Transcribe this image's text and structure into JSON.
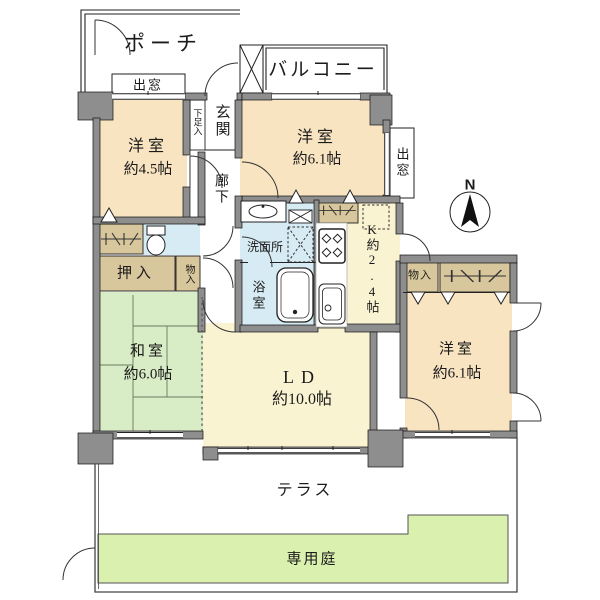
{
  "compass": {
    "north": "N"
  },
  "outdoor": {
    "porch": "ポーチ",
    "balcony": "バルコニー",
    "terrace": "テラス",
    "garden": "専用庭",
    "bay_window_top": "出窓",
    "bay_window_right": "出窓"
  },
  "entrance": {
    "genkan": "玄関",
    "shoe_cabinet": "下足入",
    "hallway": "廊下"
  },
  "rooms": {
    "western1": {
      "name": "洋室",
      "size": "約4.5帖"
    },
    "western2": {
      "name": "洋室",
      "size": "約6.1帖"
    },
    "western3": {
      "name": "洋室",
      "size": "約6.1帖"
    },
    "japanese": {
      "name": "和室",
      "size": "約6.0帖"
    },
    "living_dining": {
      "name": "LD",
      "size": "約10.0帖"
    },
    "kitchen": {
      "name": "K約2.4帖"
    }
  },
  "wet_areas": {
    "washroom": "洗面所",
    "bathroom": "浴室"
  },
  "storage": {
    "oshiire": "押入",
    "closet_hall": "物入",
    "closet_east": "物入"
  },
  "colors": {
    "room": "#f9e4c2",
    "living": "#faf3d2",
    "tatami": "#d8ecc6",
    "garden": "#daf0ae",
    "water": "#d6ebf3",
    "closet": "#d8c79c",
    "wall": "#8e8e8e"
  }
}
